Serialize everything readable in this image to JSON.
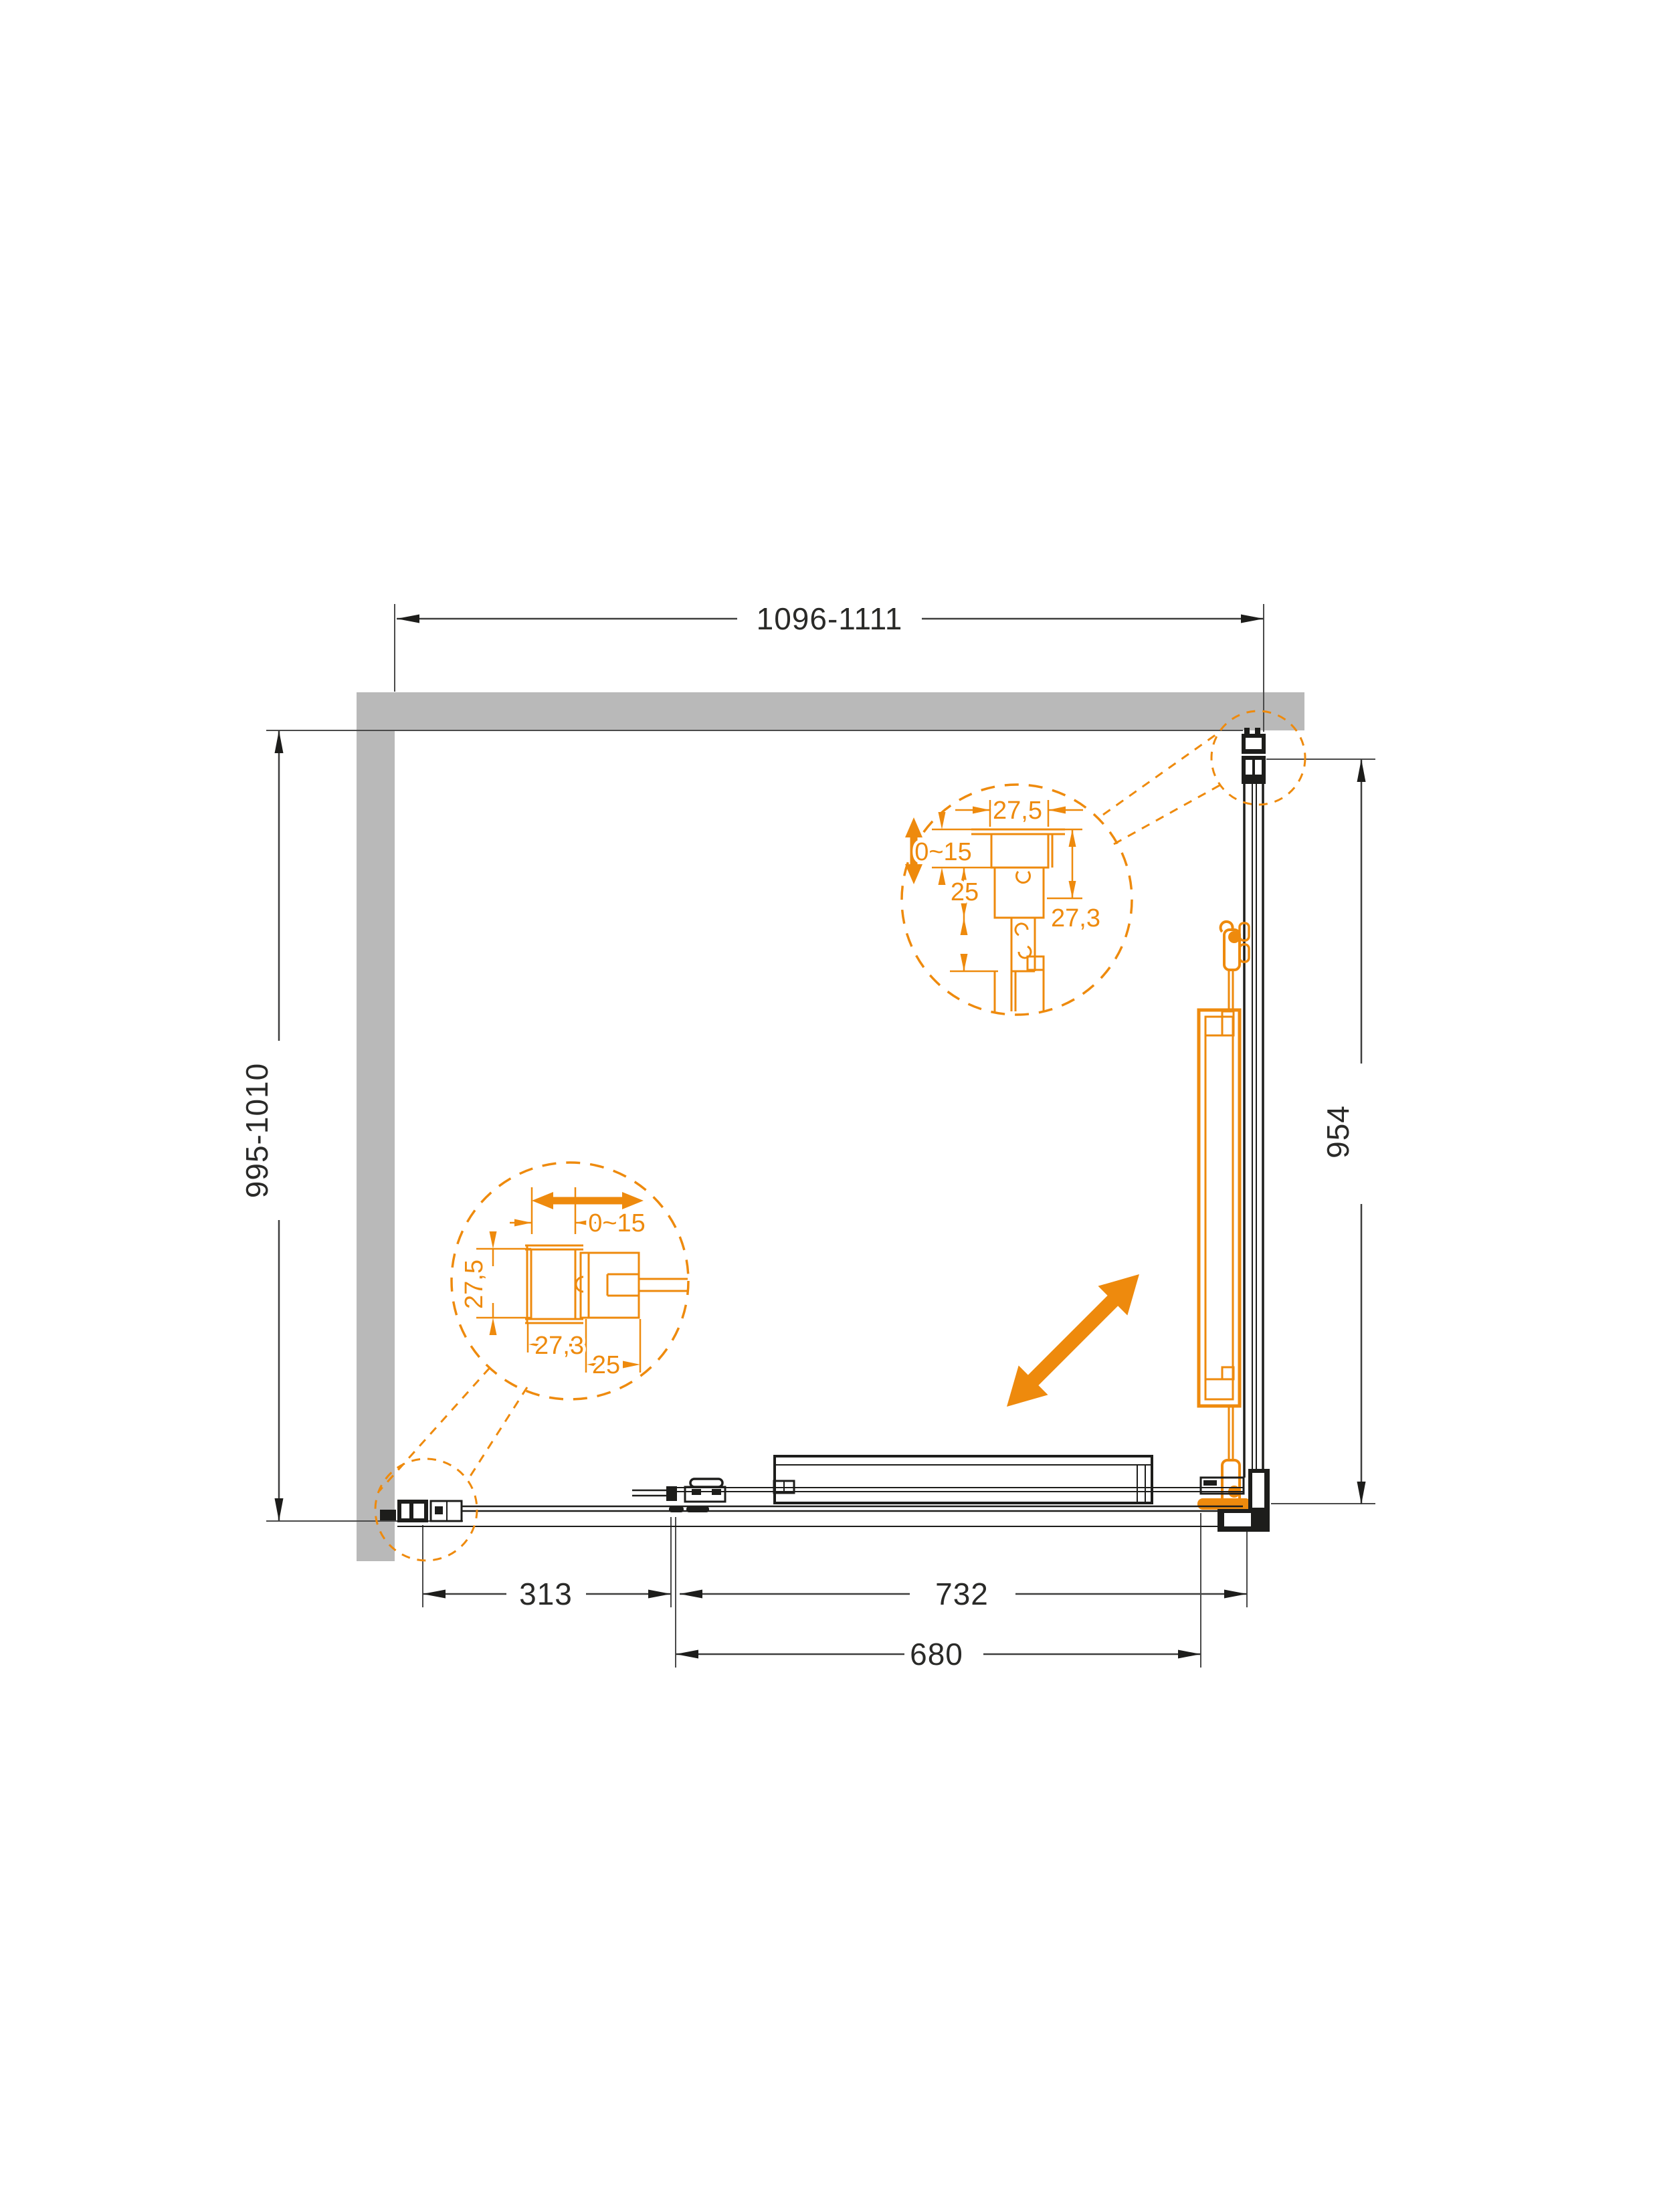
{
  "drawing": {
    "overall_dimensions": {
      "top_width_range": "1096-1111",
      "left_depth_range": "995-1010",
      "right_glass_height": "954"
    },
    "bottom_dimensions": {
      "back_fixed_panel": "313",
      "front_span": "732",
      "door_opening": "680"
    },
    "detail_top_corner": {
      "profile_width": "27,5",
      "adjustment_range": "0~15",
      "inset_depth": "25",
      "lower_depth": "24,3",
      "side_width": "27,3"
    },
    "detail_bottom_corner": {
      "adjustment_range": "0~15",
      "profile_height": "27,5",
      "profile_width": "27,3",
      "offset": "25"
    },
    "colors": {
      "accent_orange": "#EE8A0D",
      "wall_gray": "#B9B9B9",
      "line_black": "#1D1D1B",
      "dim_gray": "#3E3E3D"
    }
  }
}
